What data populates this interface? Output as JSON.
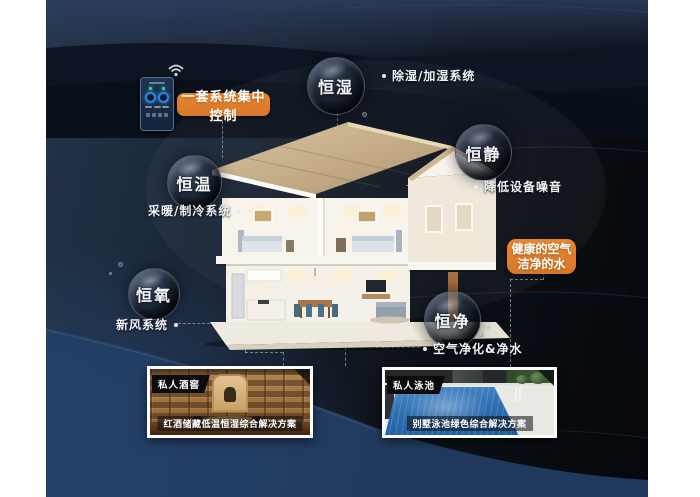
{
  "colors": {
    "accent_orange": "#dd7e2b",
    "background_navy": "#1c2c44",
    "bottom_navy": "#234068",
    "text_light": "#eef1f5"
  },
  "control": {
    "label": "一套系统集中控制"
  },
  "highlight_box": {
    "line1": "健康的空气",
    "line2": "洁净的水"
  },
  "bubbles": [
    {
      "label": "恒湿",
      "note": "除湿/加湿系统"
    },
    {
      "label": "恒静",
      "note": "降低设备噪音"
    },
    {
      "label": "恒温",
      "note": "采暖/制冷系统"
    },
    {
      "label": "恒氧",
      "note": "新风系统"
    },
    {
      "label": "恒净",
      "note": "空气净化&净水"
    }
  ],
  "cards": [
    {
      "tag": "私人酒窖",
      "caption": "红酒储藏低温恒湿综合解决方案"
    },
    {
      "tag": "私人泳池",
      "caption": "别墅泳池绿色综合解决方案"
    }
  ]
}
